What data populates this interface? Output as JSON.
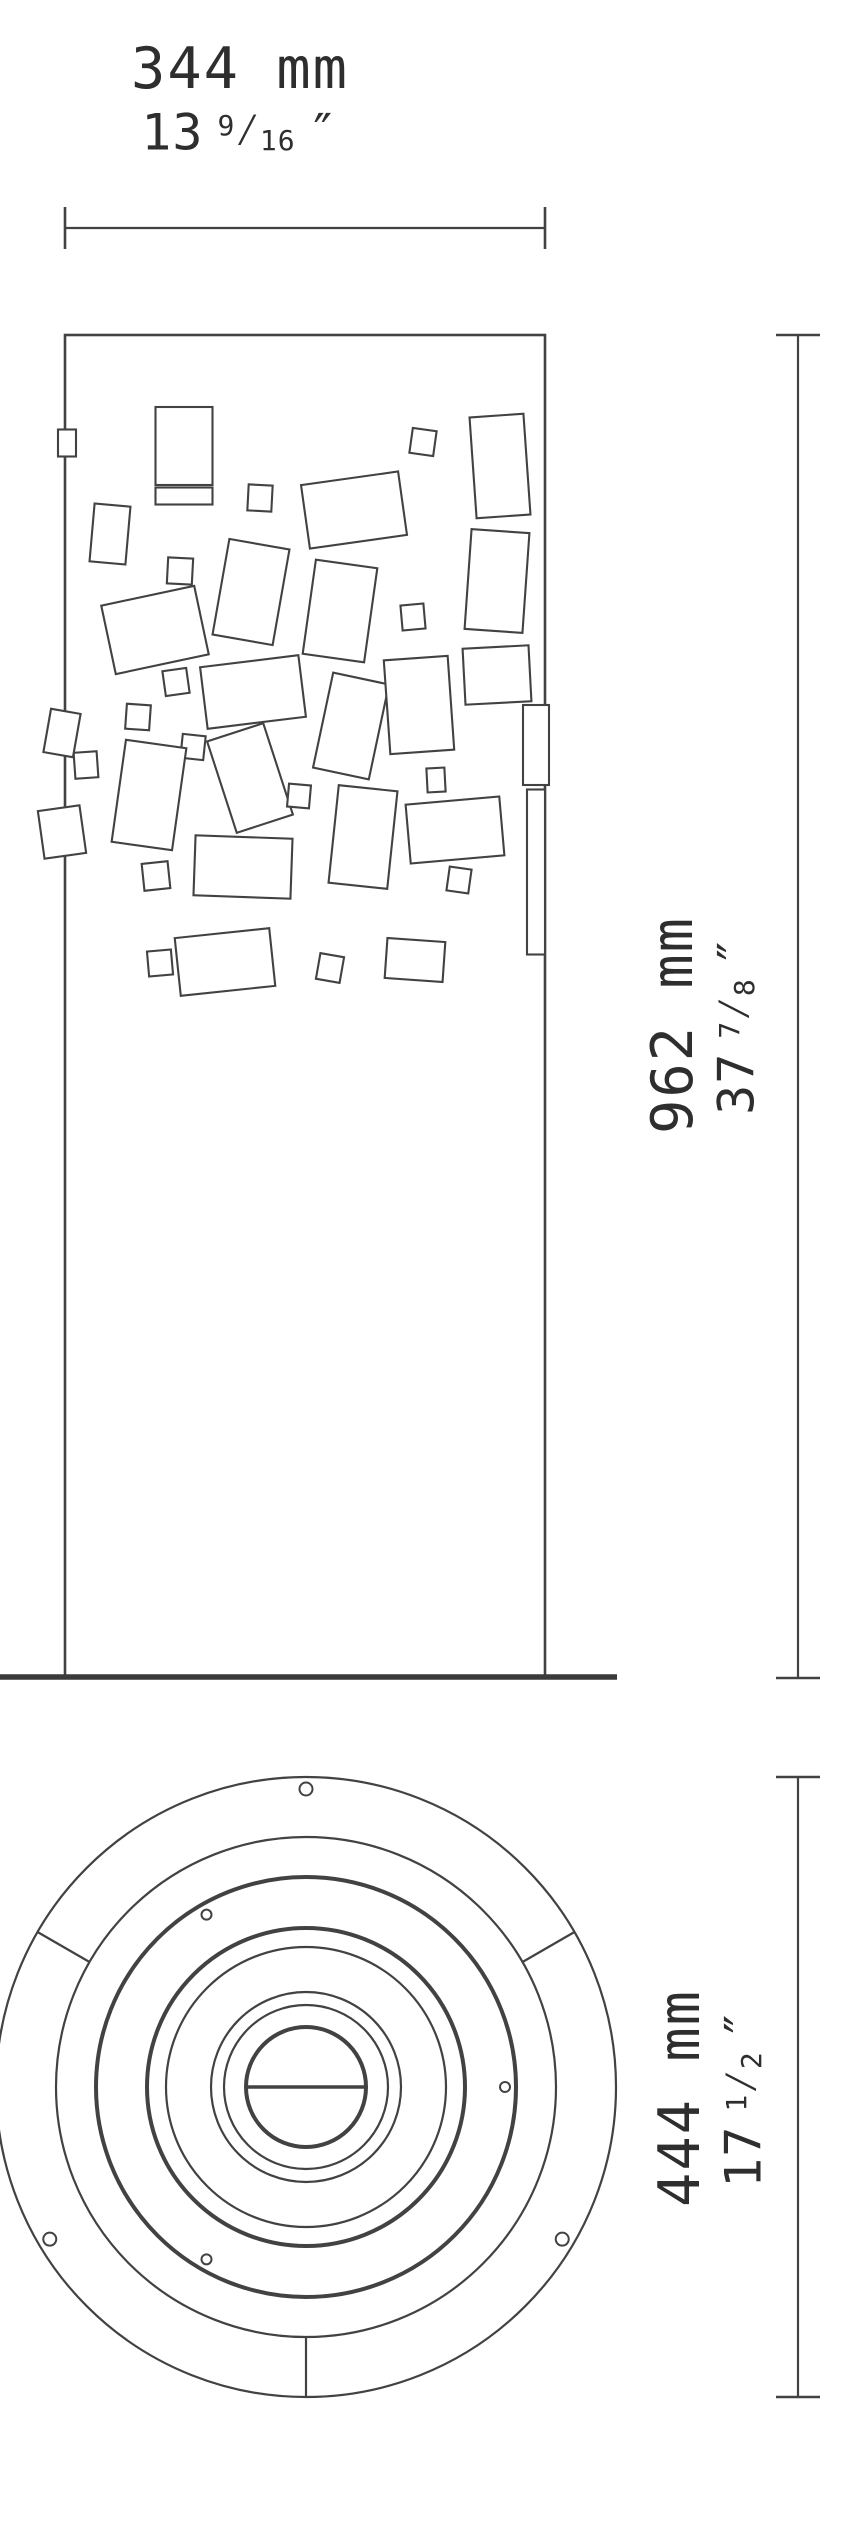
{
  "labels": {
    "frac_sep": "⁄",
    "width": {
      "mm_label": "344 mm",
      "inch_whole": "13",
      "inch_num": "9",
      "inch_den": "16",
      "inch_unit": "″"
    },
    "height": {
      "mm_label": "962 mm",
      "inch_whole": "37",
      "inch_num": "7",
      "inch_den": "8",
      "inch_unit": "″"
    },
    "diameter": {
      "mm_label": "444 mm",
      "inch_whole": "17",
      "inch_num": "1",
      "inch_den": "2",
      "inch_unit": "″"
    }
  },
  "drawing": {
    "stroke_color": "#424242",
    "ground_color": "#3a3a3a",
    "thin": 2.2,
    "bold": 4,
    "column": {
      "x": 65,
      "y": 335,
      "w": 480,
      "h": 1342
    },
    "ground_line": {
      "x1": 0,
      "x2": 617,
      "y": 1677,
      "width": 5.5
    },
    "dim_top": {
      "x1": 65,
      "x2": 545,
      "y": 228,
      "tick": 42
    },
    "dim_height": {
      "x": 798,
      "y1": 335,
      "y2": 1678,
      "tick": 44
    },
    "dim_diameter": {
      "x": 798,
      "y1": 1777,
      "y2": 2397,
      "tick": 44
    },
    "pattern_rects": [
      {
        "cx": 184,
        "cy": 446,
        "w": 57,
        "h": 78,
        "rot": 0
      },
      {
        "cx": 184,
        "cy": 496,
        "w": 57,
        "h": 17,
        "rot": 0
      },
      {
        "cx": 423,
        "cy": 442,
        "w": 24,
        "h": 25,
        "rot": 8
      },
      {
        "cx": 500,
        "cy": 466,
        "w": 54,
        "h": 101,
        "rot": -4
      },
      {
        "cx": 260,
        "cy": 498,
        "w": 24,
        "h": 26,
        "rot": 3
      },
      {
        "cx": 354,
        "cy": 510,
        "w": 98,
        "h": 64,
        "rot": -8
      },
      {
        "cx": 110,
        "cy": 534,
        "w": 36,
        "h": 58,
        "rot": 5
      },
      {
        "cx": 180,
        "cy": 571,
        "w": 25,
        "h": 26,
        "rot": 3
      },
      {
        "cx": 251,
        "cy": 592,
        "w": 61,
        "h": 97,
        "rot": 10
      },
      {
        "cx": 340,
        "cy": 611,
        "w": 62,
        "h": 95,
        "rot": 8
      },
      {
        "cx": 413,
        "cy": 617,
        "w": 23,
        "h": 25,
        "rot": -5
      },
      {
        "cx": 155,
        "cy": 630,
        "w": 95,
        "h": 70,
        "rot": -12
      },
      {
        "cx": 497,
        "cy": 581,
        "w": 58,
        "h": 100,
        "rot": 4
      },
      {
        "cx": 497,
        "cy": 675,
        "w": 66,
        "h": 56,
        "rot": -3
      },
      {
        "cx": 176,
        "cy": 682,
        "w": 24,
        "h": 25,
        "rot": -8
      },
      {
        "cx": 138,
        "cy": 717,
        "w": 24,
        "h": 25,
        "rot": 4
      },
      {
        "cx": 253,
        "cy": 692,
        "w": 99,
        "h": 62,
        "rot": -7
      },
      {
        "cx": 351,
        "cy": 726,
        "w": 57,
        "h": 97,
        "rot": 12
      },
      {
        "cx": 419,
        "cy": 705,
        "w": 64,
        "h": 94,
        "rot": -4
      },
      {
        "cx": 193,
        "cy": 747,
        "w": 23,
        "h": 24,
        "rot": 6
      },
      {
        "cx": 86,
        "cy": 765,
        "w": 23,
        "h": 26,
        "rot": -4
      },
      {
        "cx": 149,
        "cy": 795,
        "w": 61,
        "h": 103,
        "rot": 8
      },
      {
        "cx": 250,
        "cy": 778,
        "w": 59,
        "h": 96,
        "rot": -18
      },
      {
        "cx": 299,
        "cy": 796,
        "w": 22,
        "h": 23,
        "rot": 5
      },
      {
        "cx": 363,
        "cy": 837,
        "w": 59,
        "h": 98,
        "rot": 6
      },
      {
        "cx": 436,
        "cy": 780,
        "w": 18,
        "h": 24,
        "rot": -3
      },
      {
        "cx": 455,
        "cy": 830,
        "w": 94,
        "h": 59,
        "rot": -5
      },
      {
        "cx": 156,
        "cy": 876,
        "w": 26,
        "h": 27,
        "rot": -6
      },
      {
        "cx": 243,
        "cy": 867,
        "w": 97,
        "h": 60,
        "rot": 2
      },
      {
        "cx": 459,
        "cy": 880,
        "w": 22,
        "h": 24,
        "rot": 8
      },
      {
        "cx": 536,
        "cy": 872,
        "w": 18,
        "h": 165,
        "rot": 0
      },
      {
        "cx": 67,
        "cy": 443,
        "w": 18,
        "h": 27,
        "rot": 0
      },
      {
        "cx": 62,
        "cy": 733,
        "w": 30,
        "h": 44,
        "rot": 10
      },
      {
        "cx": 62,
        "cy": 832,
        "w": 42,
        "h": 48,
        "rot": -8
      },
      {
        "cx": 536,
        "cy": 745,
        "w": 26,
        "h": 80,
        "rot": 0
      },
      {
        "cx": 225,
        "cy": 962,
        "w": 95,
        "h": 58,
        "rot": -6
      },
      {
        "cx": 415,
        "cy": 960,
        "w": 58,
        "h": 40,
        "rot": 4
      },
      {
        "cx": 160,
        "cy": 963,
        "w": 24,
        "h": 25,
        "rot": -5
      },
      {
        "cx": 330,
        "cy": 968,
        "w": 24,
        "h": 26,
        "rot": 10
      }
    ],
    "circle": {
      "cx": 306,
      "cy": 2087,
      "rings": [
        {
          "r": 310,
          "w": 2.2
        },
        {
          "r": 250,
          "w": 2.2
        },
        {
          "r": 210,
          "w": 4
        },
        {
          "r": 159,
          "w": 4
        },
        {
          "r": 140,
          "w": 2.2
        },
        {
          "r": 95,
          "w": 2.2
        },
        {
          "r": 82,
          "w": 2.2
        },
        {
          "r": 60,
          "w": 4
        }
      ],
      "chord": {
        "half": 60,
        "w": 3.5
      },
      "spokes": {
        "angles": [
          30,
          150,
          270
        ],
        "r1": 250,
        "r2": 310,
        "w": 2.2
      },
      "holes": [
        {
          "r": 199,
          "angles": [
            0,
            120,
            240
          ],
          "size": 5
        },
        {
          "r": 298,
          "angles": [
            90,
            210.7,
            329.3
          ],
          "size": 6.5
        }
      ]
    }
  }
}
